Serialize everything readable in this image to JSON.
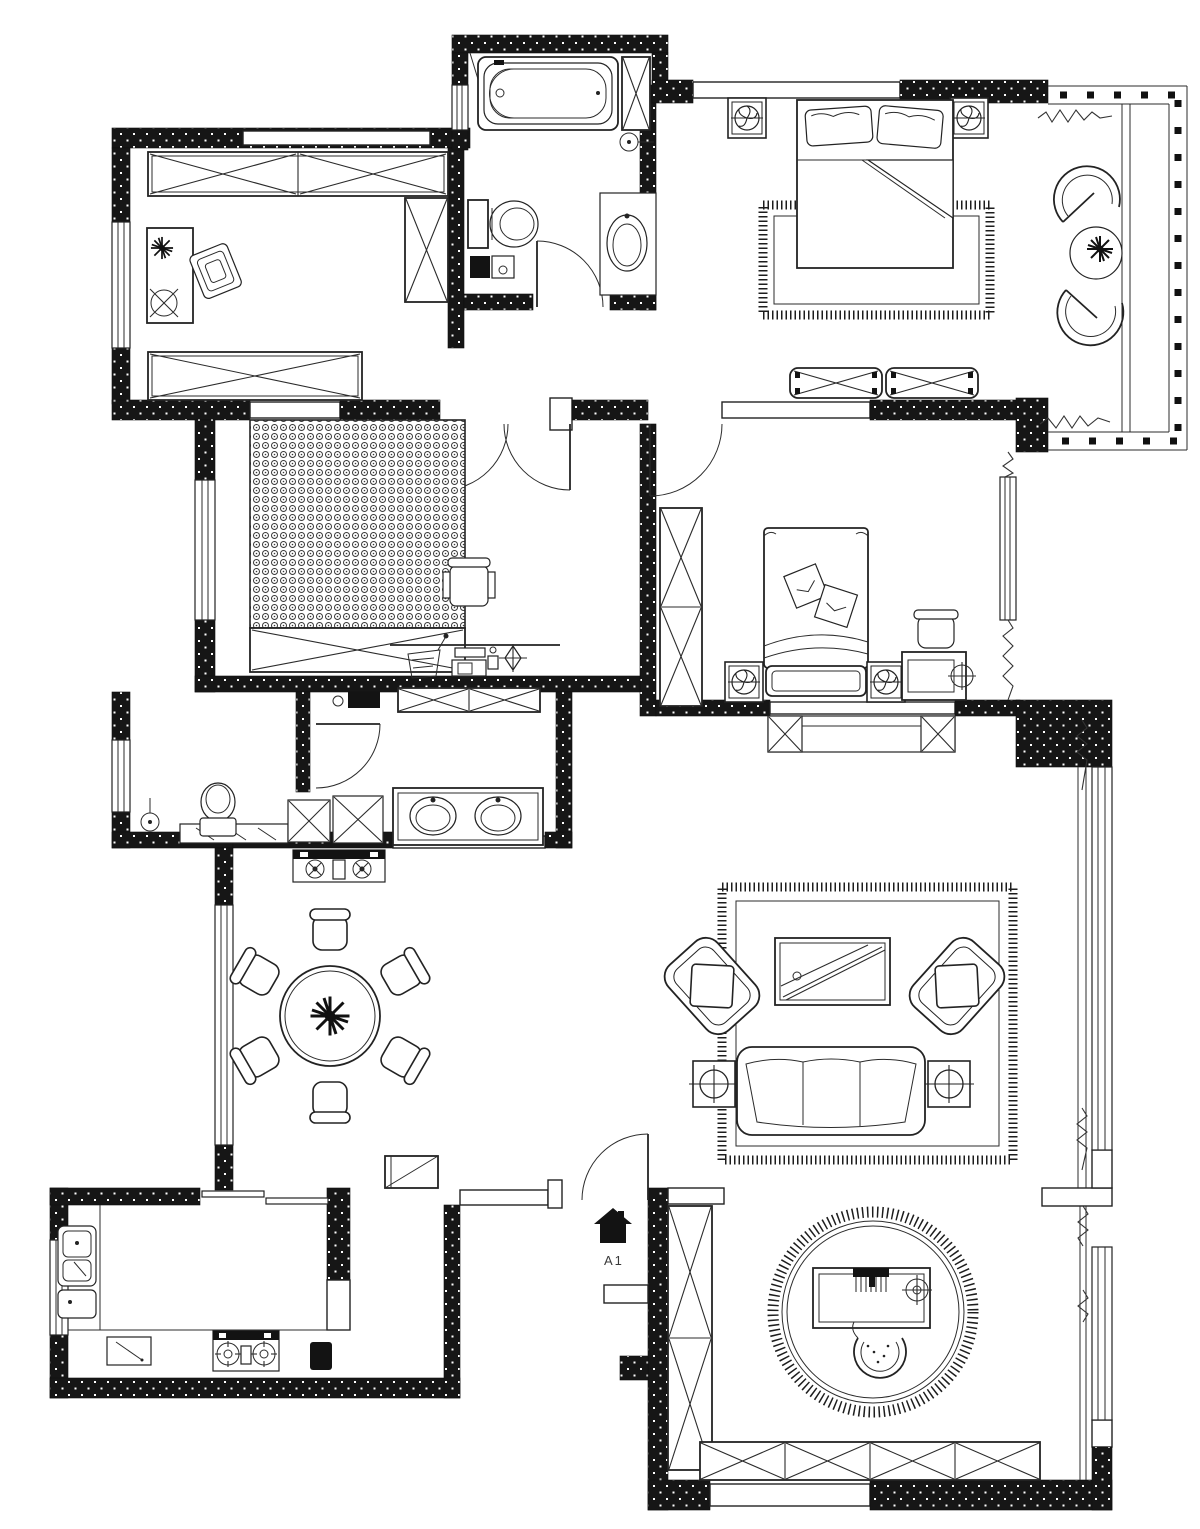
{
  "canvas": {
    "width": 1200,
    "height": 1529,
    "background": "#ffffff",
    "line_color": "#232323",
    "wall_color": "#131313"
  },
  "entrance": {
    "label": "A1",
    "icon": "entrance-house-icon"
  },
  "icons": {
    "entrance-house-icon": "black house glyph",
    "bathtub-icon": "bathtub outline",
    "toilet-icon": "toilet tank + bowl",
    "sink-icon": "oval basin",
    "double-sink-icon": "two oval basins on counter",
    "shower-head-icon": "circle with wall stem",
    "washing-machine-icon": "square with X",
    "wardrobe-icon": "rectangle with X cross",
    "bed-double-icon": "double bed with pillows",
    "bed-single-icon": "single bed with cushions",
    "nightstand-fan-icon": "square with swirl plant",
    "rug-icon": "fringed rectangle",
    "round-rug-icon": "fringed circle",
    "tv-icon": "rectangle with diagonals",
    "sofa-icon": "three seat sofa",
    "armchair-icon": "rounded chair with diamond pillow",
    "side-table-icon": "square with circled cross",
    "dining-table-icon": "round table with plant",
    "dining-chair-icon": "rounded chair",
    "plant-icon": "black snowflake plant",
    "fridge-icon": "rectangle with diagonal",
    "stove-icon": "two burners with cross ticks",
    "kitchen-sink-icon": "double bowl sink",
    "cutting-board-icon": "board with knife",
    "piano-icon": "keyboard desk on round rug",
    "stool-icon": "horseshoe stool",
    "desk-icon": "desk with chair",
    "balcony-chair-icon": "fan shaped chair",
    "window-icon": "triple parallel lines",
    "door-arc-icon": "quarter circle swing",
    "sliding-door-icon": "offset thin panels",
    "compass-icon": "diamond target",
    "mesh-area-icon": "dense bubble hatch"
  }
}
